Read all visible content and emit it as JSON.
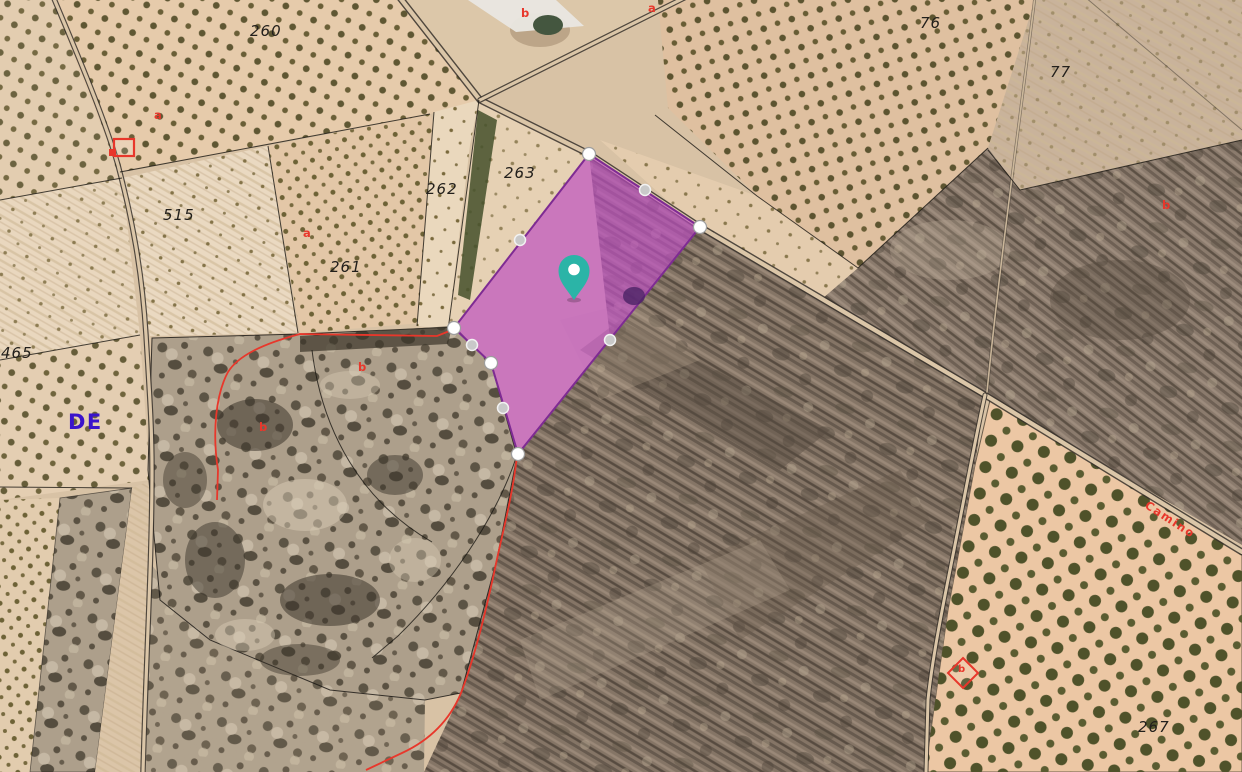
{
  "map": {
    "parcel_labels": [
      {
        "text": "260"
      },
      {
        "text": "515"
      },
      {
        "text": "262"
      },
      {
        "text": "263"
      },
      {
        "text": "261"
      },
      {
        "text": "465"
      },
      {
        "text": "76"
      },
      {
        "text": "77"
      },
      {
        "text": "267"
      }
    ],
    "red_markers": [
      {
        "text": "b"
      },
      {
        "text": "a"
      },
      {
        "text": "a"
      },
      {
        "text": "a"
      },
      {
        "text": "b"
      },
      {
        "text": "b"
      },
      {
        "text": "b"
      },
      {
        "text": "b"
      }
    ],
    "road_label": {
      "text": "Camino"
    },
    "route_label": {
      "text": "DE"
    },
    "icons": {
      "pin": "location-pin",
      "vertex": "polygon-vertex-handle",
      "midpoint": "polygon-midpoint-handle",
      "building_square": "cadastral-building-symbol",
      "building_diamond": "cadastral-building-symbol"
    },
    "colors": {
      "selected_parcel_fill": "#C351C9",
      "selected_parcel_stroke": "#7E2B93",
      "pin": "#2BB4A7",
      "cadastral_red": "#E8372B",
      "route_label_blue": "#3A13CB"
    }
  }
}
